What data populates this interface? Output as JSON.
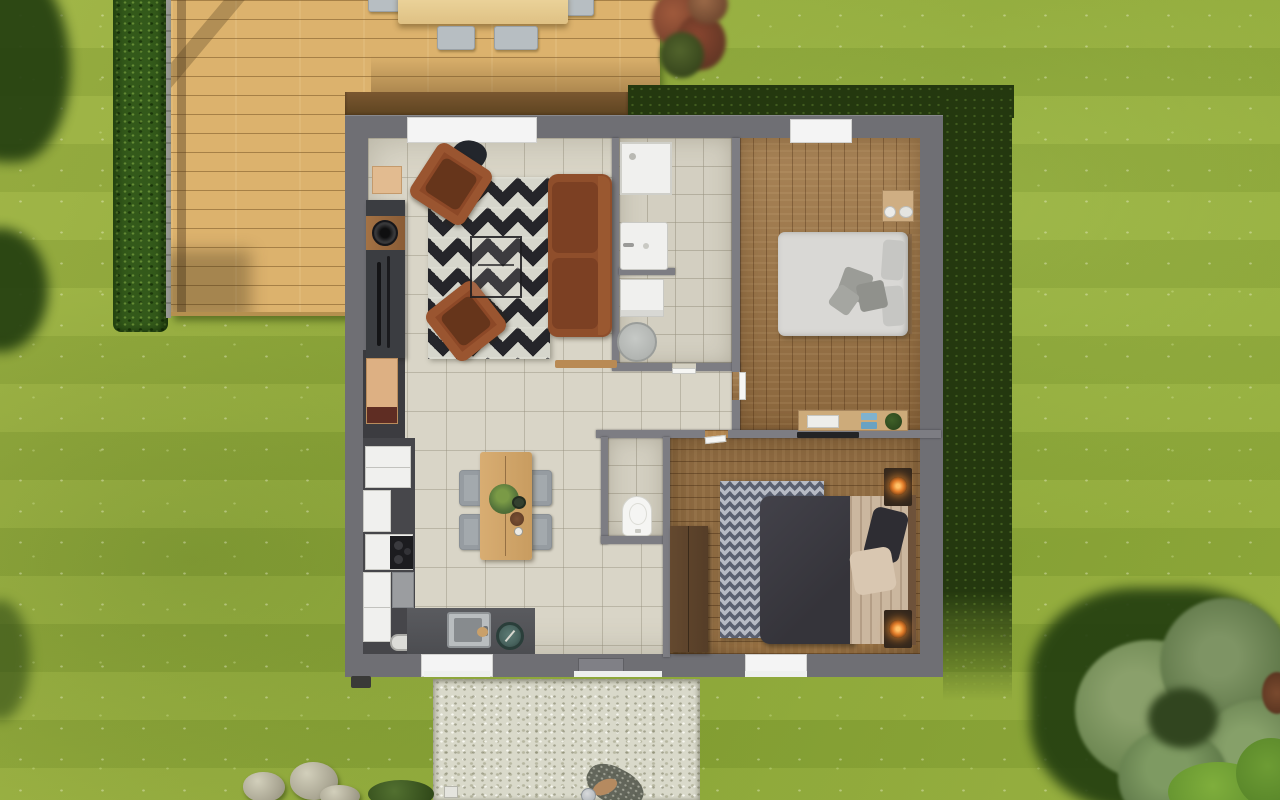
{
  "meta": {
    "type": "3d-floorplan-render",
    "view": "top-down",
    "visible_text": "none"
  },
  "palette": {
    "grass": "#92ad3e",
    "grass_shadow": "#24380f",
    "hedge": "#33591a",
    "deck_wood": "#dcb26d",
    "roof_edge": "#6f4f2c",
    "exterior_wall": "#6f6f74",
    "interior_wall": "#7d7d83",
    "tile_floor": "#d9d5c7",
    "bath_tile": "#d3cfc1",
    "bedroom_top_wood": "#9a7244",
    "bedroom_bottom_wood": "#8d6a41",
    "sofa": "#8f4e2b",
    "living_rug": "#25252a",
    "bedroom_rug": "#5a6070",
    "bed_top_mattress": "#d9d8d5",
    "bed_bottom_duvet": "#3c3b41",
    "bed_bottom_blanket": "#cbb79f",
    "gravel_path": "#d9d9ca",
    "tree_canopy": "#6d8752",
    "lamp_glow": "#ff9a3c",
    "window": "#f4f4f4"
  },
  "house": {
    "rooms": [
      {
        "name": "living-room",
        "floor": "tile",
        "furniture": [
          "sofa",
          "armchair",
          "armchair",
          "zigzag-rug",
          "coffee-table",
          "tv-console",
          "wall-shelf"
        ]
      },
      {
        "name": "kitchen-dining",
        "floor": "tile",
        "furniture": [
          "fridge",
          "stove",
          "sink-counter",
          "cabinets",
          "dining-table",
          "four-chairs",
          "table-plant"
        ]
      },
      {
        "name": "bathroom",
        "floor": "tile",
        "fixtures": [
          "shower",
          "sink",
          "washing-machine",
          "laundry-basket"
        ]
      },
      {
        "name": "wc",
        "floor": "tile",
        "fixtures": [
          "toilet"
        ]
      },
      {
        "name": "bedroom-top",
        "floor": "wood",
        "furniture": [
          "double-bed",
          "nightstand",
          "desk",
          "desk-plant"
        ]
      },
      {
        "name": "bedroom-bottom",
        "floor": "wood",
        "furniture": [
          "double-bed",
          "wardrobe",
          "nightstand-lamp",
          "nightstand-lamp",
          "chevron-rug",
          "wall-tv"
        ]
      },
      {
        "name": "hallway",
        "floor": "tile"
      }
    ],
    "windows": 4,
    "doors": [
      "front-sliding-door",
      "bathroom-door",
      "bedroom-top-door",
      "bedroom-bottom-door"
    ]
  },
  "exterior": {
    "features": [
      "wood-deck",
      "outdoor-dining-table",
      "deck-chairs",
      "hedge-row",
      "garden-fence",
      "red-shrub",
      "gravel-path",
      "stepping-rocks",
      "garden-shrub",
      "large-tree",
      "bright-bushes",
      "lawn",
      "tree-shadows",
      "person-walking"
    ]
  }
}
